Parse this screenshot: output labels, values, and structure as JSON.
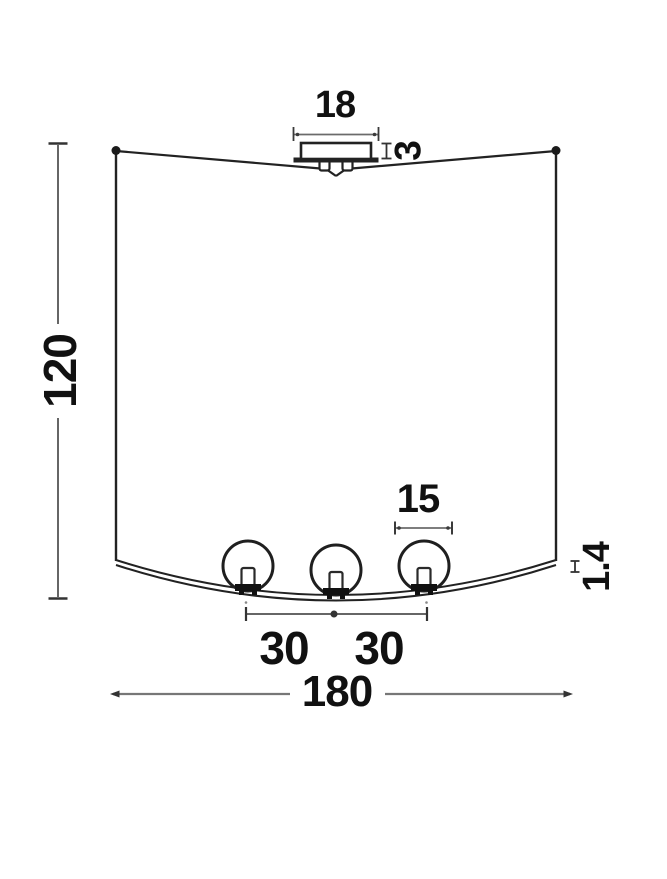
{
  "diagram": {
    "title": "ceiling-lamp-dimension-drawing",
    "dimensions": {
      "canopy_width": "18",
      "canopy_height": "3",
      "fixture_height": "120",
      "globe_diameter": "15",
      "shade_thickness": "1.4",
      "globe_spacing_left": "30",
      "globe_spacing_right": "30",
      "fixture_width": "180"
    },
    "colors": {
      "background": "#ffffff",
      "outline": "#222222",
      "dimension_line": "#6b6b6b",
      "dimension_tick": "#333333",
      "text": "#111111"
    }
  }
}
